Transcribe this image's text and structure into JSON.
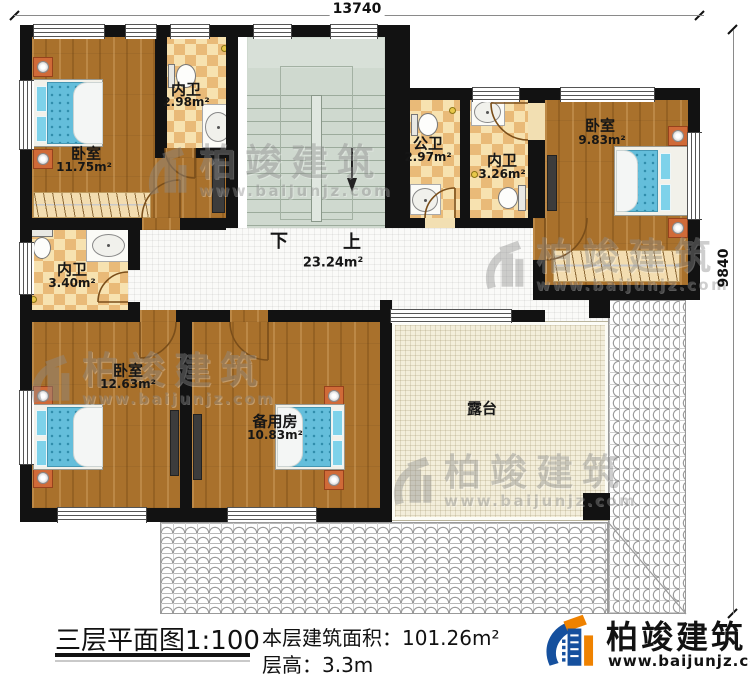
{
  "dimensions": {
    "top": "13740",
    "right": "9840"
  },
  "rooms": {
    "bedroom_tl": {
      "name": "卧室",
      "area": "11.75m²"
    },
    "bath_tl": {
      "name": "内卫",
      "area": "2.98m²"
    },
    "bath_public": {
      "name": "公卫",
      "area": "2.97m²"
    },
    "bath_tm": {
      "name": "内卫",
      "area": "3.26m²"
    },
    "bedroom_tr": {
      "name": "卧室",
      "area": "9.83m²"
    },
    "bath_ml": {
      "name": "内卫",
      "area": "3.40m²"
    },
    "bedroom_bl": {
      "name": "卧室",
      "area": "12.63m²"
    },
    "spare_room": {
      "name": "备用房",
      "area": "10.83m²"
    },
    "terrace": {
      "name": "露台"
    },
    "hallway": {
      "area": "23.24m²",
      "stair_down": "下",
      "stair_up": "上"
    }
  },
  "watermark": {
    "brand": "柏竣建筑",
    "url": "www.baijunjz.com"
  },
  "footer": {
    "title": "三层平面图1:100",
    "area_label": "本层建筑面积：",
    "area_value": "101.26m²",
    "height_label": "层高：",
    "height_value": "3.3m",
    "brand": "柏竣建筑",
    "brand_url": "www.baijunjz.com"
  }
}
